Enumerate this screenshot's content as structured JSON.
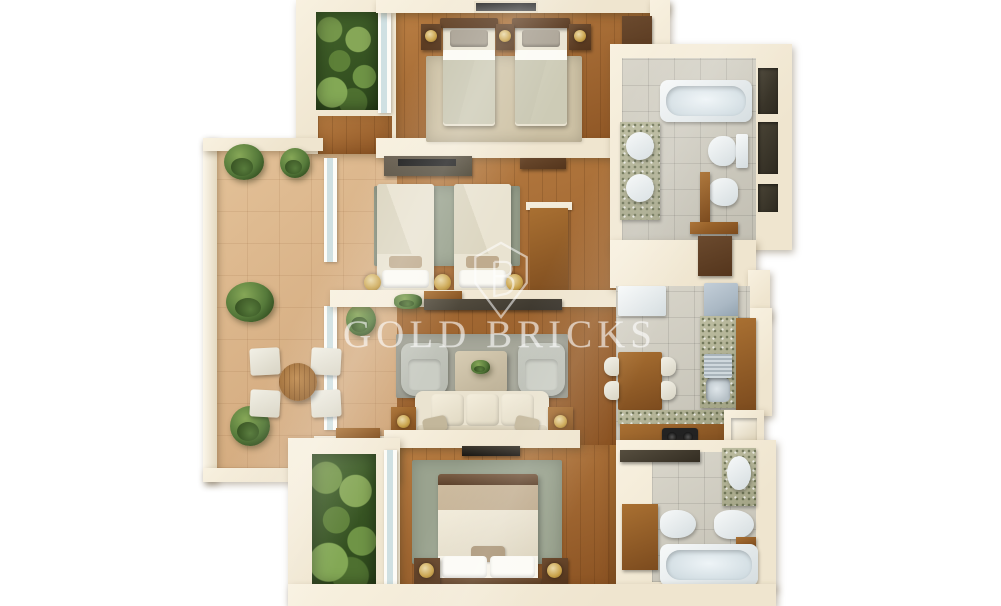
{
  "watermark": {
    "brand_text": "GOLD BRICKS",
    "logo_icon": "shield-b-monogram-icon"
  },
  "plan": {
    "type": "3d-floor-plan-top-view",
    "background": "#ffffff",
    "rooms": [
      {
        "id": "bedroom-top",
        "contents": [
          "twin-bed",
          "twin-bed",
          "nightstand-x3",
          "table-lamp-x3",
          "wardrobe",
          "rug",
          "window"
        ]
      },
      {
        "id": "bathroom-top-right",
        "contents": [
          "bathtub",
          "granite-counter",
          "round-sink-x2",
          "toilet",
          "bidet",
          "door",
          "wall-niche-x3"
        ]
      },
      {
        "id": "terrace-left",
        "contents": [
          "round-table",
          "chair-x4",
          "potted-plant-x5",
          "railing",
          "window-wall"
        ]
      },
      {
        "id": "bedroom-middle",
        "contents": [
          "twin-bed",
          "twin-bed",
          "tv-cabinet",
          "desk",
          "rug",
          "table-lamp-x3",
          "door"
        ]
      },
      {
        "id": "living-room",
        "contents": [
          "sofa-3-seat",
          "armchair-x2",
          "coffee-table",
          "side-table-x2",
          "rug",
          "media-console"
        ]
      },
      {
        "id": "kitchen-dining",
        "contents": [
          "dining-table",
          "chair-x4",
          "refrigerator",
          "sink",
          "cooktop",
          "granite-counter",
          "wood-counter",
          "wall-niche"
        ]
      },
      {
        "id": "bedroom-master",
        "contents": [
          "double-bed",
          "nightstand-x2",
          "table-lamp-x2",
          "rug",
          "tv",
          "window-wall"
        ]
      },
      {
        "id": "bathroom-bottom-right",
        "contents": [
          "bathtub",
          "granite-counter",
          "oval-sink",
          "toilet",
          "bidet",
          "wood-cabinet"
        ]
      },
      {
        "id": "planter-top-left",
        "contents": [
          "greenery"
        ]
      },
      {
        "id": "planter-bottom-left",
        "contents": [
          "greenery"
        ]
      }
    ]
  },
  "colors": {
    "wall": "#efe5cf",
    "wallHi": "#f8f1e0",
    "woodLight": "#b97e43",
    "woodDark": "#8a5222",
    "woodItem": "#a97032",
    "woodItemDark": "#7c4b1e",
    "darkWood": "#54351c",
    "terraceLight": "#e3c198",
    "terraceDark": "#cfa477",
    "tileLight": "#d9d6cb",
    "tileDark": "#c2bfb3",
    "rugBeige": "#cfc3a6",
    "rugSage": "#9aa38f",
    "rugGray": "#a6a79a",
    "sofaCream": "#eae3d0",
    "chairGray": "#b6b9b0",
    "bedCream": "#e9e3d1",
    "bedSage": "#cdcbb6",
    "bedTan": "#bfab8e",
    "fixtureWhite": "#f7f9f9",
    "fixtureShade": "#d5dde0",
    "steel": "#b7c1c7",
    "fridge": "#aab8c4",
    "greenDark": "#2c461b",
    "greenMid": "#55793a",
    "greenLight": "#86a757",
    "gold": "#c9a24a",
    "watermark": "rgba(255,255,255,0.55)"
  }
}
